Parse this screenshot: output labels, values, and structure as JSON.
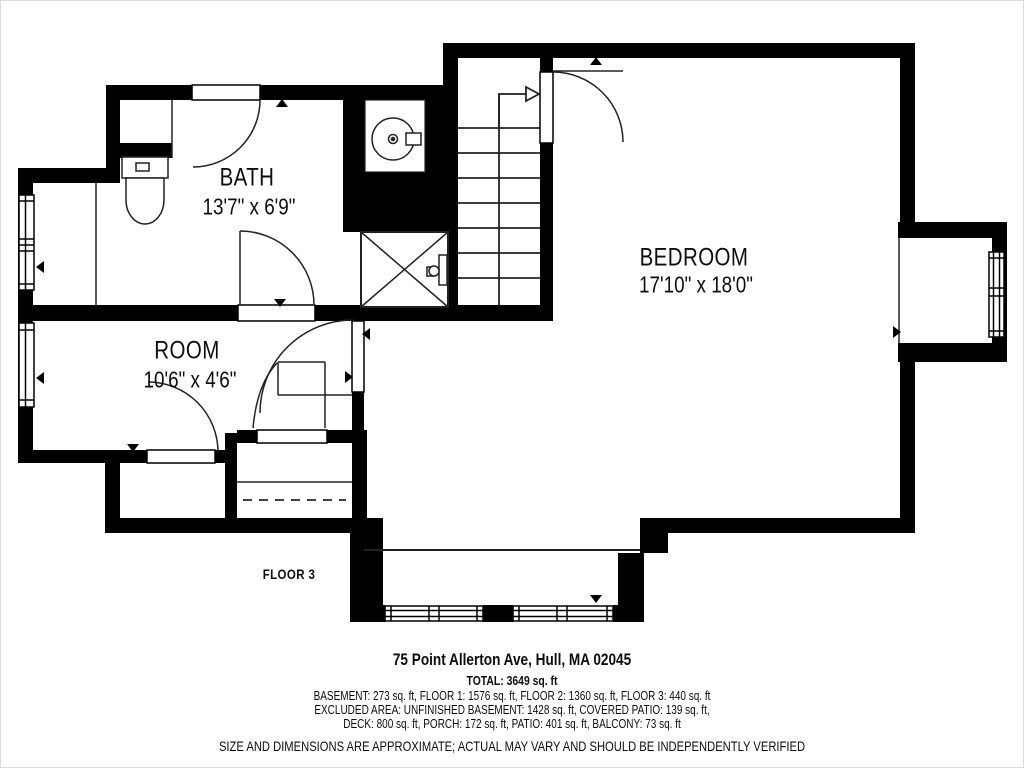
{
  "floor_plan": {
    "rooms": {
      "bath": {
        "name": "BATH",
        "dims": "13'7\" x 6'9\""
      },
      "room": {
        "name": "ROOM",
        "dims": "10'6\" x 4'6\""
      },
      "bedroom": {
        "name": "BEDROOM",
        "dims": "17'10\" x 18'0\""
      }
    },
    "floor_label": "FLOOR 3",
    "fixtures": {
      "toilet": "toilet-icon",
      "sink": "sink-icon",
      "shower": "shower-icon",
      "stairs": "staircase-up-arrow"
    },
    "colors": {
      "walls": "#000000",
      "background": "#ffffff"
    }
  },
  "footer": {
    "address": "75 Point Allerton Ave, Hull, MA 02045",
    "total": "TOTAL: 3649 sq. ft",
    "area_breakdown": "BASEMENT: 273 sq. ft, FLOOR 1: 1576 sq. ft, FLOOR 2: 1360 sq. ft, FLOOR 3: 440 sq. ft",
    "excluded_line1": "EXCLUDED AREA: UNFINISHED BASEMENT: 1428 sq. ft, COVERED PATIO: 139 sq. ft,",
    "excluded_line2": "DECK: 800 sq. ft, PORCH: 172 sq. ft, PATIO: 401 sq. ft, BALCONY: 73 sq. ft",
    "disclaimer": "SIZE AND DIMENSIONS ARE APPROXIMATE; ACTUAL MAY VARY AND SHOULD BE INDEPENDENTLY VERIFIED"
  }
}
